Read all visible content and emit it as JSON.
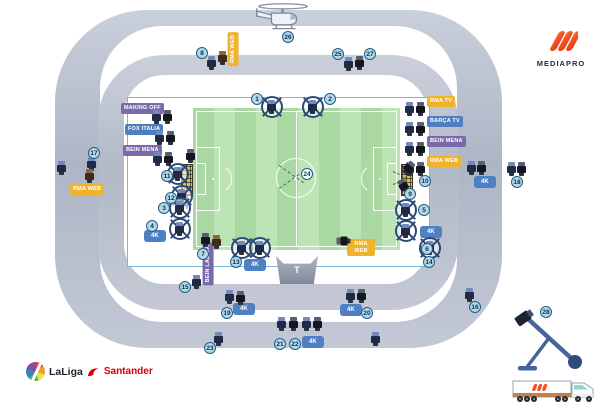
{
  "logos": {
    "mediapro": {
      "text": "MEDIAPRO"
    },
    "laliga": {
      "left": "LaLiga",
      "right": "Santander"
    }
  },
  "platform": {
    "label": "T"
  },
  "colors": {
    "yellow": "#f0b32c",
    "blue": "#4d7fc0",
    "purple": "#7b6aab",
    "fourk_blue": "#4f80c4",
    "badge_fill": "#b5d8e9",
    "badge_border": "#1f5e86",
    "pitch_light": "#bce4b4",
    "pitch_dark": "#aad8a2",
    "ring_gray": "#b9bfcc",
    "mediapro_orange": "#f4511e",
    "santander_red": "#d40000"
  },
  "broadcast_labels": [
    {
      "text": "MAKING OFF",
      "color": "purple",
      "x": 121,
      "y": 103
    },
    {
      "text": "FOX ITALIA",
      "color": "blue",
      "x": 125,
      "y": 124
    },
    {
      "text": "BEIN MENA",
      "color": "purple",
      "x": 123,
      "y": 145
    },
    {
      "text": "RMA TV",
      "color": "yellow",
      "x": 427,
      "y": 96
    },
    {
      "text": "BARÇA TV",
      "color": "blue",
      "x": 427,
      "y": 116
    },
    {
      "text": "BEIN MENA",
      "color": "purple",
      "x": 427,
      "y": 136
    },
    {
      "text": "RMA WEB",
      "color": "yellow",
      "x": 427,
      "y": 156
    },
    {
      "text": "RMA WEB",
      "color": "yellow",
      "x": 70,
      "y": 184
    },
    {
      "text": "RMA WEB",
      "color": "yellow",
      "x": 228,
      "y": 32,
      "vertical": true
    },
    {
      "text": "BEIN LALIGA",
      "color": "purple",
      "x": 203,
      "y": 242,
      "vertical": true
    },
    {
      "text": "RMA WEB",
      "color": "yellow",
      "x": 347,
      "y": 239,
      "twoline": true
    }
  ],
  "uhd_labels": {
    "text": "4K",
    "positions": [
      [
        144,
        230
      ],
      [
        420,
        226
      ],
      [
        474,
        176
      ],
      [
        244,
        259
      ],
      [
        233,
        303
      ],
      [
        340,
        304
      ],
      [
        302,
        336
      ]
    ]
  },
  "cameras": [
    {
      "x": 344,
      "y": 57,
      "t": "p",
      "c": "navy"
    },
    {
      "x": 355,
      "y": 56,
      "t": "p",
      "c": "black"
    },
    {
      "x": 207,
      "y": 56,
      "t": "p",
      "c": "navy"
    },
    {
      "x": 218,
      "y": 51,
      "t": "p",
      "c": "brown"
    },
    {
      "x": 261,
      "y": 96,
      "t": "r"
    },
    {
      "x": 302,
      "y": 96,
      "t": "r"
    },
    {
      "x": 152,
      "y": 110,
      "t": "p",
      "c": "navy"
    },
    {
      "x": 163,
      "y": 110,
      "t": "p",
      "c": "black"
    },
    {
      "x": 155,
      "y": 131,
      "t": "p",
      "c": "navy"
    },
    {
      "x": 166,
      "y": 131,
      "t": "p",
      "c": "black"
    },
    {
      "x": 153,
      "y": 152,
      "t": "p",
      "c": "navy"
    },
    {
      "x": 164,
      "y": 152,
      "t": "p",
      "c": "black"
    },
    {
      "x": 405,
      "y": 102,
      "t": "p",
      "c": "navy"
    },
    {
      "x": 416,
      "y": 102,
      "t": "p",
      "c": "black"
    },
    {
      "x": 405,
      "y": 122,
      "t": "p",
      "c": "navy"
    },
    {
      "x": 416,
      "y": 122,
      "t": "p",
      "c": "black"
    },
    {
      "x": 405,
      "y": 142,
      "t": "p",
      "c": "navy"
    },
    {
      "x": 416,
      "y": 142,
      "t": "p",
      "c": "black"
    },
    {
      "x": 405,
      "y": 162,
      "t": "p",
      "c": "navy"
    },
    {
      "x": 416,
      "y": 162,
      "t": "p",
      "c": "black"
    },
    {
      "x": 87,
      "y": 157,
      "t": "p",
      "c": "navy"
    },
    {
      "x": 85,
      "y": 169,
      "t": "p",
      "c": "brown"
    },
    {
      "x": 57,
      "y": 161,
      "t": "p",
      "c": "navy"
    },
    {
      "x": 467,
      "y": 161,
      "t": "p",
      "c": "navy"
    },
    {
      "x": 477,
      "y": 161,
      "t": "p",
      "c": "black"
    },
    {
      "x": 507,
      "y": 162,
      "t": "p",
      "c": "navy"
    },
    {
      "x": 517,
      "y": 162,
      "t": "p",
      "c": "black"
    },
    {
      "x": 186,
      "y": 149,
      "t": "p",
      "c": "black"
    },
    {
      "x": 167,
      "y": 163,
      "t": "r"
    },
    {
      "x": 171,
      "y": 185,
      "t": "r"
    },
    {
      "x": 404,
      "y": 161,
      "t": "p",
      "c": "black",
      "rot": 40
    },
    {
      "x": 399,
      "y": 179,
      "t": "p",
      "c": "black",
      "rot": -30
    },
    {
      "x": 169,
      "y": 197,
      "t": "r"
    },
    {
      "x": 169,
      "y": 218,
      "t": "r"
    },
    {
      "x": 395,
      "y": 199,
      "t": "r"
    },
    {
      "x": 395,
      "y": 220,
      "t": "r"
    },
    {
      "x": 201,
      "y": 233,
      "t": "p",
      "c": "black"
    },
    {
      "x": 212,
      "y": 235,
      "t": "p",
      "c": "brown"
    },
    {
      "x": 231,
      "y": 237,
      "t": "r"
    },
    {
      "x": 249,
      "y": 237,
      "t": "r"
    },
    {
      "x": 419,
      "y": 237,
      "t": "r"
    },
    {
      "x": 339,
      "y": 234,
      "t": "p",
      "c": "black",
      "rot": -90
    },
    {
      "x": 192,
      "y": 275,
      "t": "p",
      "c": "navy"
    },
    {
      "x": 225,
      "y": 290,
      "t": "p",
      "c": "navy"
    },
    {
      "x": 236,
      "y": 291,
      "t": "p",
      "c": "black"
    },
    {
      "x": 346,
      "y": 289,
      "t": "p",
      "c": "navy"
    },
    {
      "x": 357,
      "y": 289,
      "t": "p",
      "c": "black"
    },
    {
      "x": 465,
      "y": 288,
      "t": "p",
      "c": "navy"
    },
    {
      "x": 277,
      "y": 317,
      "t": "p",
      "c": "navy"
    },
    {
      "x": 289,
      "y": 317,
      "t": "p",
      "c": "black"
    },
    {
      "x": 302,
      "y": 317,
      "t": "p",
      "c": "navy"
    },
    {
      "x": 313,
      "y": 317,
      "t": "p",
      "c": "black"
    },
    {
      "x": 214,
      "y": 332,
      "t": "p",
      "c": "navy"
    },
    {
      "x": 371,
      "y": 332,
      "t": "p",
      "c": "navy"
    }
  ],
  "number_badges": [
    {
      "n": "1",
      "x": 251,
      "y": 93
    },
    {
      "n": "2",
      "x": 324,
      "y": 93
    },
    {
      "n": "3",
      "x": 158,
      "y": 202
    },
    {
      "n": "4",
      "x": 146,
      "y": 220
    },
    {
      "n": "5",
      "x": 418,
      "y": 204
    },
    {
      "n": "6",
      "x": 421,
      "y": 243
    },
    {
      "n": "7",
      "x": 197,
      "y": 248
    },
    {
      "n": "8",
      "x": 196,
      "y": 47
    },
    {
      "n": "9",
      "x": 404,
      "y": 188
    },
    {
      "n": "10",
      "x": 419,
      "y": 175
    },
    {
      "n": "11",
      "x": 161,
      "y": 170
    },
    {
      "n": "12",
      "x": 165,
      "y": 192
    },
    {
      "n": "13",
      "x": 230,
      "y": 256
    },
    {
      "n": "14",
      "x": 423,
      "y": 256
    },
    {
      "n": "15",
      "x": 179,
      "y": 281
    },
    {
      "n": "16",
      "x": 469,
      "y": 301
    },
    {
      "n": "17",
      "x": 88,
      "y": 147
    },
    {
      "n": "18",
      "x": 511,
      "y": 176
    },
    {
      "n": "19",
      "x": 221,
      "y": 307
    },
    {
      "n": "20",
      "x": 361,
      "y": 307
    },
    {
      "n": "21",
      "x": 274,
      "y": 338
    },
    {
      "n": "22",
      "x": 289,
      "y": 338
    },
    {
      "n": "23",
      "x": 204,
      "y": 342
    },
    {
      "n": "24",
      "x": 301,
      "y": 168,
      "style": "white"
    },
    {
      "n": "25",
      "x": 332,
      "y": 48
    },
    {
      "n": "26",
      "x": 282,
      "y": 31
    },
    {
      "n": "27",
      "x": 364,
      "y": 48
    },
    {
      "n": "28",
      "x": 540,
      "y": 306
    }
  ],
  "sightlines": [
    {
      "x": 393,
      "y": 171,
      "len": 16,
      "rot": 25
    },
    {
      "x": 393,
      "y": 184,
      "len": 15,
      "rot": -20
    },
    {
      "x": 279,
      "y": 165,
      "len": 30,
      "rot": 35
    },
    {
      "x": 279,
      "y": 188,
      "len": 30,
      "rot": -35
    }
  ]
}
